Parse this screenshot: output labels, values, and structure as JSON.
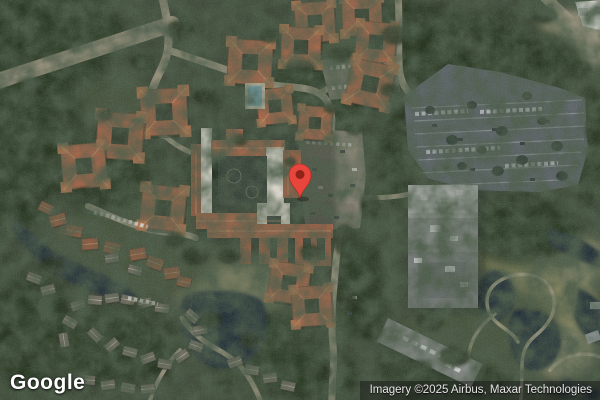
{
  "map": {
    "mode": "satellite",
    "marker": {
      "color": "#E8453C",
      "dot_color": "#8F2318"
    },
    "palette": {
      "canvas": "#3f4936",
      "trees_dark": "#28341f",
      "trees_mid": "#49543b",
      "grass": "#8d8d6d",
      "road": "#a79d86",
      "clearing": "#9b947c",
      "roof_terracotta": "#b26a4a",
      "roof_ridge": "#d8a377",
      "roof_white": "#e6e1d4",
      "gray_building": "#9fa29f",
      "parking_asphalt": "#636a6f",
      "parking_tan": "#8d8777",
      "water": "#232e39",
      "pool": "#7fb6c9",
      "townhouse": "#7d7568"
    }
  },
  "watermark": {
    "logo_text": "Google"
  },
  "attribution": {
    "text": "Imagery ©2025 Airbus, Maxar Technologies"
  }
}
